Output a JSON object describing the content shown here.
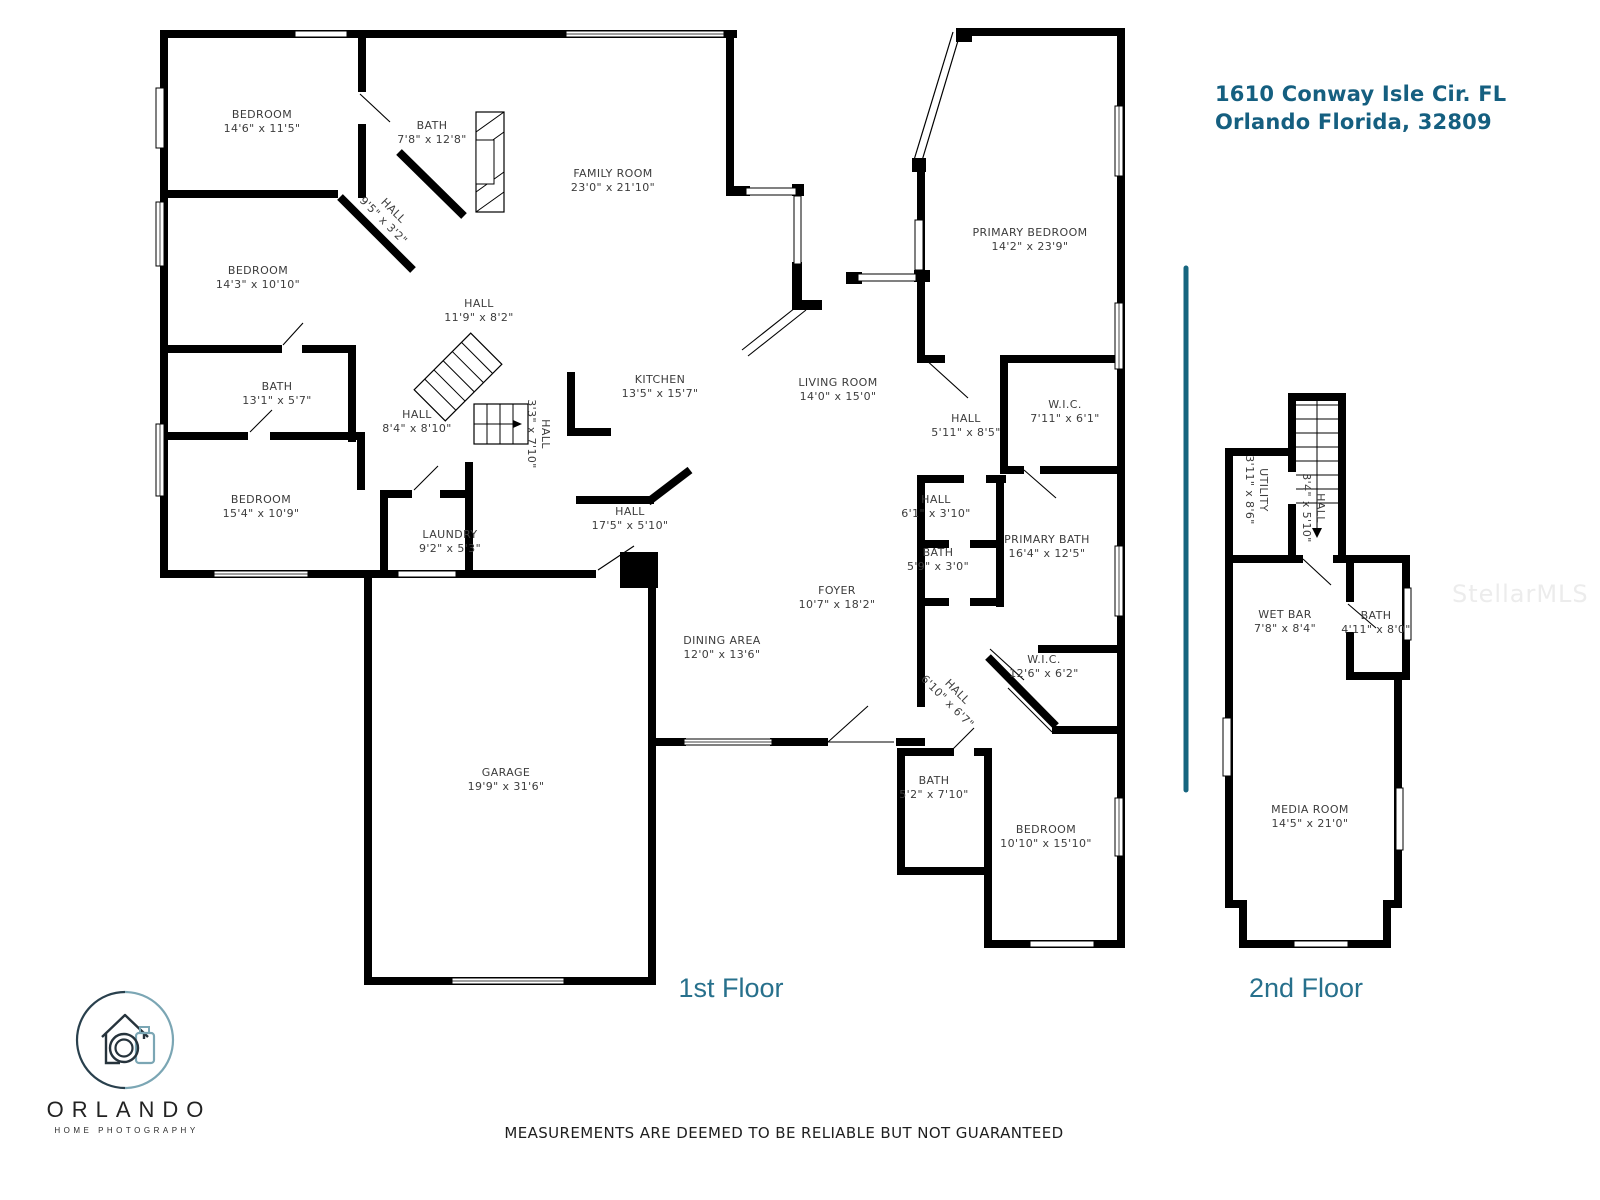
{
  "title": {
    "line1": "1610 Conway Isle Cir. FL",
    "line2": "Orlando Florida, 32809"
  },
  "floors": {
    "first_label": "1st Floor",
    "second_label": "2nd Floor"
  },
  "disclaimer": "MEASUREMENTS ARE DEEMED TO BE RELIABLE BUT NOT GUARANTEED",
  "watermark": "StellarMLS",
  "logo": {
    "name": "ORLANDO",
    "tagline": "HOME PHOTOGRAPHY",
    "icon": "house-camera-icon"
  },
  "colors": {
    "title_teal": "#155f80",
    "caption_teal": "#27708c",
    "divider_teal": "#16657f",
    "wall_black": "#000000",
    "label_gray": "#3c3c3c",
    "watermark_gray": "#ececec"
  },
  "rooms": {
    "f1_bedroom1": {
      "name": "BEDROOM",
      "dims": "14'6\" x 11'5\""
    },
    "f1_bath1": {
      "name": "BATH",
      "dims": "7'8\" x 12'8\""
    },
    "f1_hall_diag1": {
      "name": "HALL",
      "dims": "9'5\" x 3'2\""
    },
    "f1_family_room": {
      "name": "FAMILY ROOM",
      "dims": "23'0\" x 21'10\""
    },
    "f1_bedroom2": {
      "name": "BEDROOM",
      "dims": "14'3\" x 10'10\""
    },
    "f1_hall_main": {
      "name": "HALL",
      "dims": "11'9\" x 8'2\""
    },
    "f1_bath2": {
      "name": "BATH",
      "dims": "13'1\" x 5'7\""
    },
    "f1_hall_back": {
      "name": "HALL",
      "dims": "8'4\" x 8'10\""
    },
    "f1_hall_vert": {
      "name": "HALL",
      "dims": "3'3\" x 7'10\""
    },
    "f1_kitchen": {
      "name": "KITCHEN",
      "dims": "13'5\" x 15'7\""
    },
    "f1_living_room": {
      "name": "LIVING ROOM",
      "dims": "14'0\" x 15'0\""
    },
    "f1_primary_bedroom": {
      "name": "PRIMARY BEDROOM",
      "dims": "14'2\" x 23'9\""
    },
    "f1_hall_suite": {
      "name": "HALL",
      "dims": "5'11\" x 8'5\""
    },
    "f1_wic_small": {
      "name": "W.I.C.",
      "dims": "7'11\" x 6'1\""
    },
    "f1_bedroom3": {
      "name": "BEDROOM",
      "dims": "15'4\" x 10'9\""
    },
    "f1_laundry": {
      "name": "LAUNDRY",
      "dims": "9'2\" x 5'3\""
    },
    "f1_hall_long": {
      "name": "HALL",
      "dims": "17'5\" x 5'10\""
    },
    "f1_hall_small": {
      "name": "HALL",
      "dims": "6'1\" x 3'10\""
    },
    "f1_bath3": {
      "name": "BATH",
      "dims": "5'9\" x 3'0\""
    },
    "f1_primary_bath": {
      "name": "PRIMARY BATH",
      "dims": "16'4\" x 12'5\""
    },
    "f1_foyer": {
      "name": "FOYER",
      "dims": "10'7\" x 18'2\""
    },
    "f1_dining_area": {
      "name": "DINING AREA",
      "dims": "12'0\" x 13'6\""
    },
    "f1_wic_large": {
      "name": "W.I.C.",
      "dims": "12'6\" x 6'2\""
    },
    "f1_hall_diag2": {
      "name": "HALL",
      "dims": "6'10\" x 6'7\""
    },
    "f1_garage": {
      "name": "GARAGE",
      "dims": "19'9\" x 31'6\""
    },
    "f1_bath4": {
      "name": "BATH",
      "dims": "5'2\" x 7'10\""
    },
    "f1_bedroom4": {
      "name": "BEDROOM",
      "dims": "10'10\" x 15'10\""
    },
    "f2_utility": {
      "name": "UTILITY",
      "dims": "3'11\" x 8'6\""
    },
    "f2_hall": {
      "name": "HALL",
      "dims": "3'4\" x 5'10\""
    },
    "f2_wet_bar": {
      "name": "WET BAR",
      "dims": "7'8\" x 8'4\""
    },
    "f2_bath": {
      "name": "BATH",
      "dims": "4'11\" x 8'0\""
    },
    "f2_media_room": {
      "name": "MEDIA ROOM",
      "dims": "14'5\" x 21'0\""
    }
  }
}
